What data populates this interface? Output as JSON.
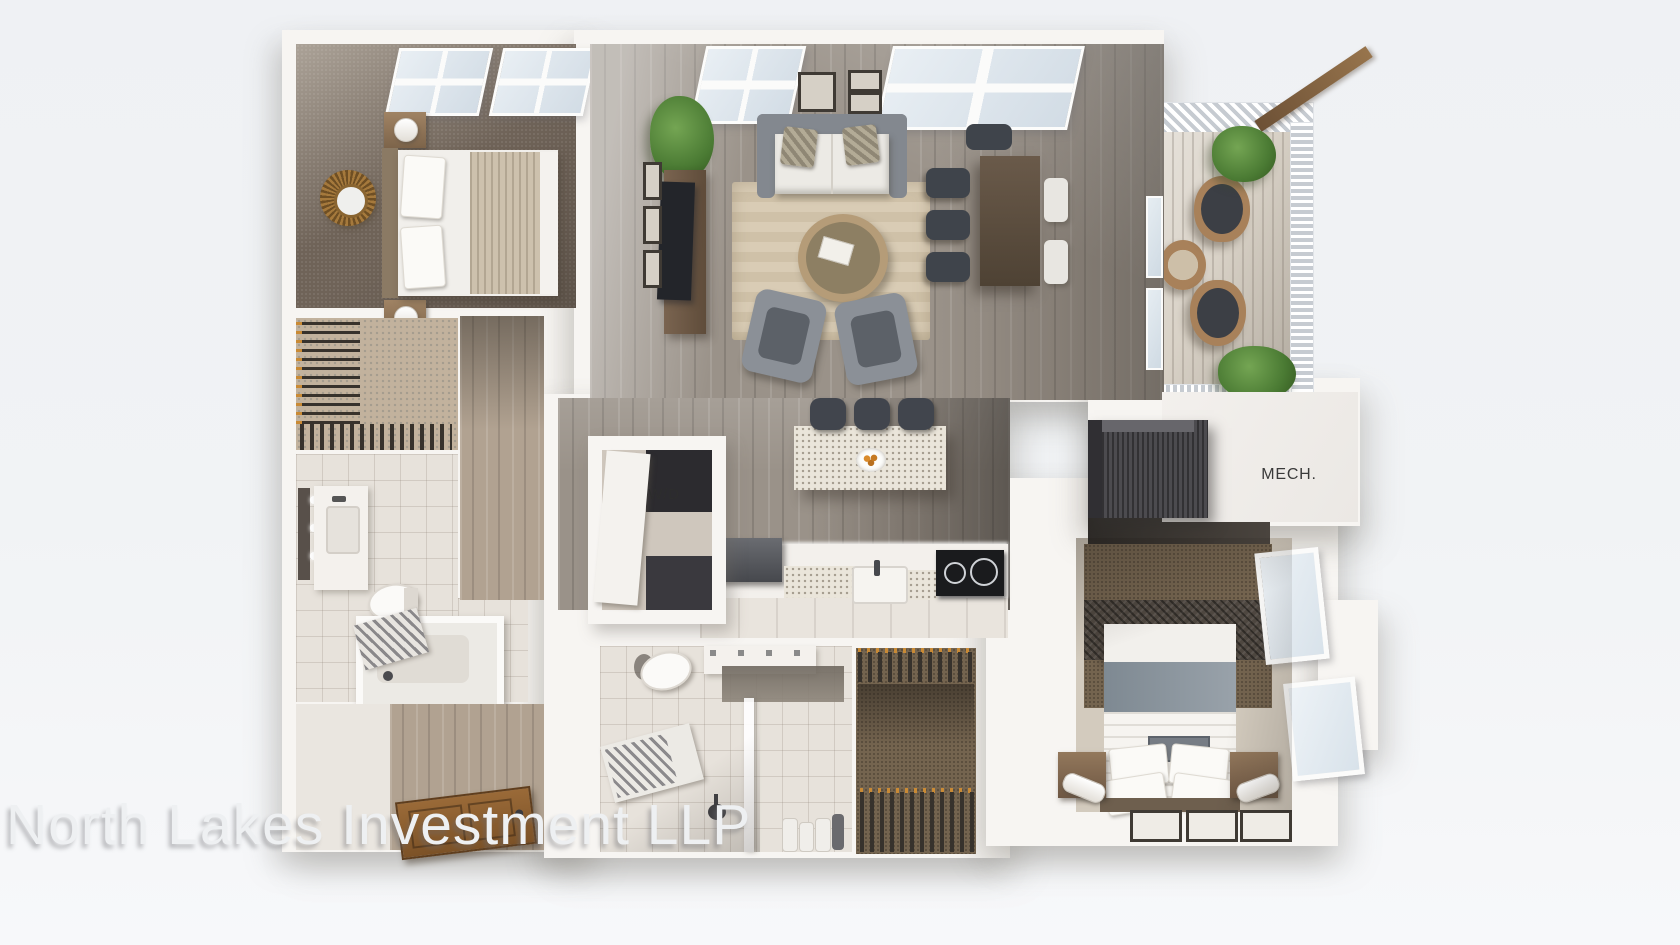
{
  "scene": {
    "description": "3D aerial rendering of a two-bedroom apartment floor plan",
    "watermark": "North Lakes Investment LLP",
    "labels": {
      "mechanical": "MECH.",
      "washer_dryer": "W/D"
    },
    "rooms": [
      "bedroom 1",
      "walk-in closet 1",
      "bathroom 1",
      "entry hall",
      "living room",
      "dining area",
      "kitchen",
      "washer-dryer closet",
      "bathroom 2",
      "walk-in closet 2",
      "bedroom 2",
      "mechanical room",
      "balcony"
    ],
    "furniture": [
      "bed",
      "nightstands",
      "lamps",
      "sunburst-mirror",
      "sofa",
      "accent-pillows",
      "armchairs",
      "round-coffee-table",
      "area-rug",
      "media-console",
      "tv",
      "dining-table",
      "dining-chairs",
      "kitchen-island",
      "bar-stools",
      "fruit-bowl",
      "refrigerator",
      "sink",
      "cooktop",
      "toilet",
      "bathtub",
      "vanity",
      "walk-in-shower",
      "shower-bench",
      "wicker-patio-chairs",
      "wicker-side-table",
      "potted-plants",
      "picture-frames",
      "entry-door",
      "washer-dryer-stack",
      "mechanical-unit"
    ],
    "colors": {
      "page_background": "#f1f2f5",
      "walls": "#f7f5f2",
      "wood_floor": "#9a9289",
      "dark_carpet": "#6f6358",
      "area_rug": "#d5c8b1",
      "balcony_floor": "#d9d2c7",
      "plant_green": "#57853d",
      "label_text": "#3a3a3a",
      "watermark_text": "#eef0f2"
    }
  }
}
